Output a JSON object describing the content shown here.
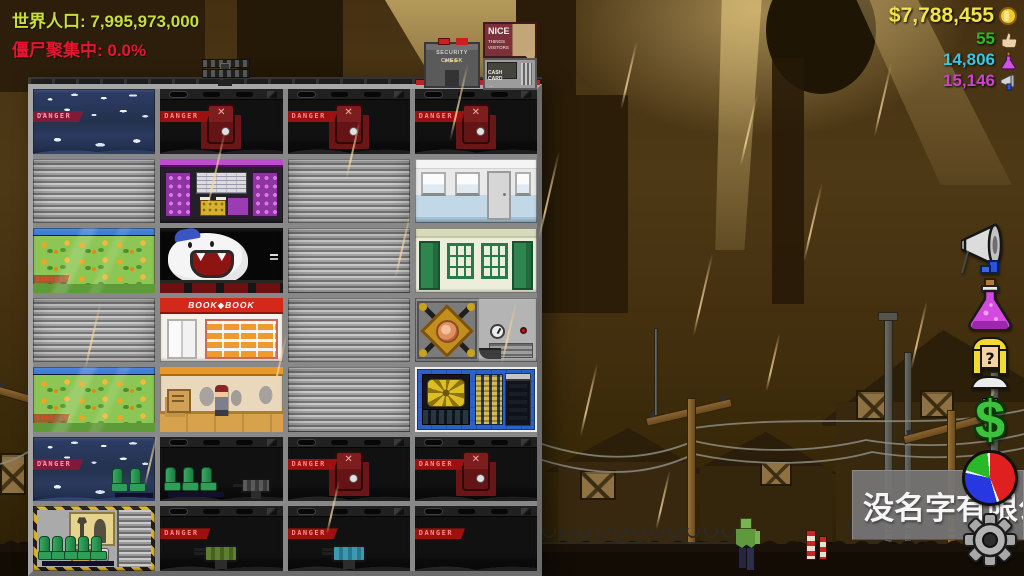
{
  "hud": {
    "world_population": "世界人口: 7,995,973,000",
    "zombie_gathering": "僵尸聚集中: 0.0%",
    "money": "$7,788,455",
    "likes": "55",
    "science": "14,806",
    "influence": "15,146"
  },
  "signs": {
    "danger": "DANGER",
    "bookstore": "BOOK◆BOOK",
    "nice_line1": "NICE",
    "nice_line2": "THINGS",
    "nice_line3": "VISITORS",
    "security_line1": "SECURITY",
    "security_line2": "CHECK",
    "security_arrows": "▶▶▶",
    "cash_line1": "CASH",
    "cash_line2": "CARD",
    "cash_arrow": "→",
    "dollar_menu": "$"
  },
  "overlay": {
    "company_name": "没名字有限公"
  },
  "colors": {
    "population_text": "#c9de38",
    "alert_text": "#e81430",
    "money_text": "#f2e44c",
    "likes_text": "#2db828",
    "science_text": "#38c8e0",
    "influence_text": "#cc44cc",
    "selection_hazard": "#e0b425",
    "selected_room_border": "#eeeeee"
  },
  "building": {
    "rooms": [
      [
        "frozen-storage",
        "containment-robot",
        "containment-robot",
        "containment-robot"
      ],
      [
        "closed-shutter",
        "purple-lab",
        "closed-shutter",
        "bathroom"
      ],
      [
        "greenhouse",
        "mascot-room",
        "closed-shutter",
        "school-room"
      ],
      [
        "closed-shutter",
        "bookstore",
        "closed-shutter",
        "food-machine"
      ],
      [
        "greenhouse",
        "post-office",
        "closed-shutter",
        "server-room-selected"
      ],
      [
        "frozen-seats",
        "seats-and-turret",
        "containment-robot",
        "containment-robot"
      ],
      [
        "workshop-selected",
        "turret-green",
        "turret-blue",
        "containment-empty"
      ]
    ]
  }
}
